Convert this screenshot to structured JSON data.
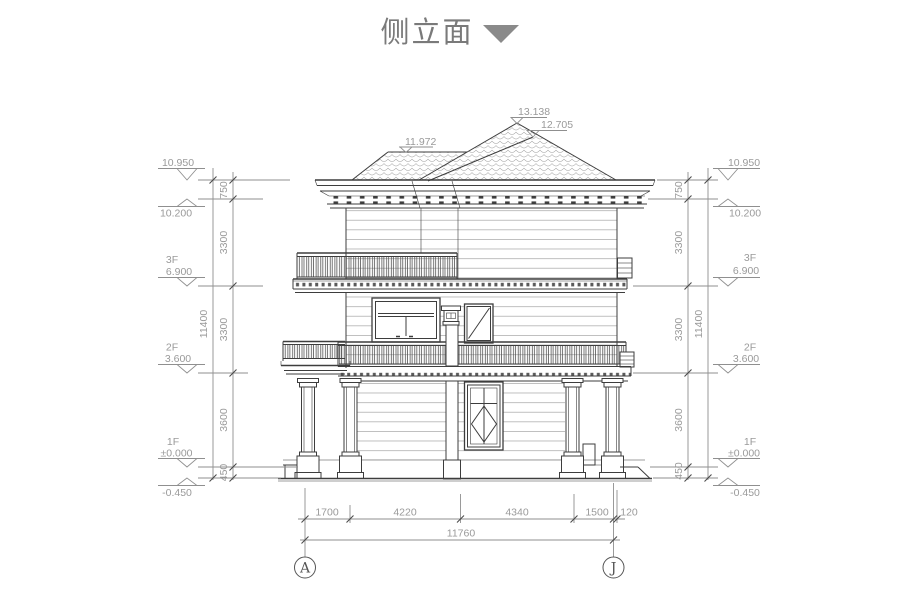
{
  "title": "侧立面",
  "roof_labels": {
    "main_peak": "13.138",
    "secondary_peak": "12.705",
    "left_ridge": "11.972"
  },
  "elevation_markers": [
    {
      "floor": "",
      "value": "10.950"
    },
    {
      "floor": "",
      "value": "10.200"
    },
    {
      "floor": "3F",
      "value": "6.900"
    },
    {
      "floor": "2F",
      "value": "3.600"
    },
    {
      "floor": "1F",
      "value": "±0.000"
    },
    {
      "floor": "",
      "value": "-0.450"
    }
  ],
  "vertical_dims": {
    "segments": [
      "750",
      "3300",
      "3300",
      "3600",
      "450"
    ],
    "overall": "11400"
  },
  "horizontal_dims": {
    "segments": [
      "1700",
      "4220",
      "4340",
      "1500",
      "120"
    ],
    "overall": "11760"
  },
  "grid_axes": {
    "left": "A",
    "right": "J"
  },
  "colors": {
    "line_dark": "#3d3d3d",
    "dim_gray": "#8f8f8f",
    "text_gray": "#9a9a9a",
    "title_gray": "#7a7a7a"
  }
}
